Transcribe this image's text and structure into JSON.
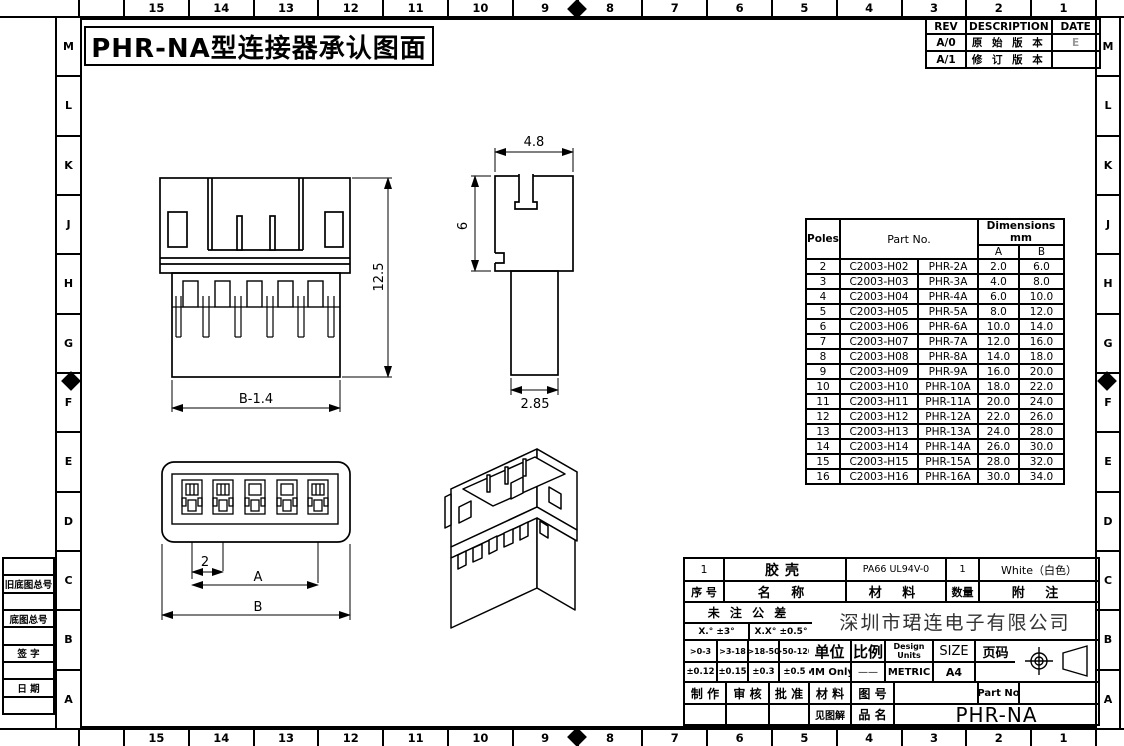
{
  "sheet": {
    "title": "PHR-NA型连接器承认图面",
    "ruler_numbers": [
      "15",
      "14",
      "13",
      "12",
      "11",
      "10",
      "9",
      "8",
      "7",
      "6",
      "5",
      "4",
      "3",
      "2",
      "1"
    ],
    "letters": [
      "M",
      "L",
      "K",
      "J",
      "H",
      "G",
      "F",
      "E",
      "D",
      "C",
      "B",
      "A"
    ],
    "margin_boxes": [
      "",
      "旧底图总号",
      "",
      "底图总号",
      "",
      "签 字",
      "",
      "日 期",
      ""
    ]
  },
  "rev_table": {
    "headers": [
      "REV",
      "DESCRIPTION",
      "DATE"
    ],
    "rows": [
      {
        "rev": "A/0",
        "desc": "原 始 版 本",
        "date": "E"
      },
      {
        "rev": "A/1",
        "desc": "修 订 版 本",
        "date": ""
      }
    ]
  },
  "parts_table": {
    "header": {
      "poles": "Poles",
      "part_no": "Part No.",
      "dims": "Dimensions mm",
      "a": "A",
      "b": "B"
    },
    "rows": [
      {
        "poles": "2",
        "part1": "C2003-H02",
        "part2": "PHR-2A",
        "a": "2.0",
        "b": "6.0"
      },
      {
        "poles": "3",
        "part1": "C2003-H03",
        "part2": "PHR-3A",
        "a": "4.0",
        "b": "8.0"
      },
      {
        "poles": "4",
        "part1": "C2003-H04",
        "part2": "PHR-4A",
        "a": "6.0",
        "b": "10.0"
      },
      {
        "poles": "5",
        "part1": "C2003-H05",
        "part2": "PHR-5A",
        "a": "8.0",
        "b": "12.0"
      },
      {
        "poles": "6",
        "part1": "C2003-H06",
        "part2": "PHR-6A",
        "a": "10.0",
        "b": "14.0"
      },
      {
        "poles": "7",
        "part1": "C2003-H07",
        "part2": "PHR-7A",
        "a": "12.0",
        "b": "16.0"
      },
      {
        "poles": "8",
        "part1": "C2003-H08",
        "part2": "PHR-8A",
        "a": "14.0",
        "b": "18.0"
      },
      {
        "poles": "9",
        "part1": "C2003-H09",
        "part2": "PHR-9A",
        "a": "16.0",
        "b": "20.0"
      },
      {
        "poles": "10",
        "part1": "C2003-H10",
        "part2": "PHR-10A",
        "a": "18.0",
        "b": "22.0"
      },
      {
        "poles": "11",
        "part1": "C2003-H11",
        "part2": "PHR-11A",
        "a": "20.0",
        "b": "24.0"
      },
      {
        "poles": "12",
        "part1": "C2003-H12",
        "part2": "PHR-12A",
        "a": "22.0",
        "b": "26.0"
      },
      {
        "poles": "13",
        "part1": "C2003-H13",
        "part2": "PHR-13A",
        "a": "24.0",
        "b": "28.0"
      },
      {
        "poles": "14",
        "part1": "C2003-H14",
        "part2": "PHR-14A",
        "a": "26.0",
        "b": "30.0"
      },
      {
        "poles": "15",
        "part1": "C2003-H15",
        "part2": "PHR-15A",
        "a": "28.0",
        "b": "32.0"
      },
      {
        "poles": "16",
        "part1": "C2003-H16",
        "part2": "PHR-16A",
        "a": "30.0",
        "b": "34.0"
      }
    ]
  },
  "dims": {
    "front_width": "B-1.4",
    "front_height": "12.5",
    "side_width": "4.8",
    "side_height": "6",
    "side_stem": "2.85",
    "pitch": "2",
    "dim_a": "A",
    "dim_b": "B"
  },
  "title_block": {
    "bom": {
      "no": "1",
      "name": "胶壳",
      "material": "PA66 UL94V-0",
      "qty": "1",
      "note": "White（白色）"
    },
    "bom_header": {
      "no": "序 号",
      "name": "名  称",
      "material": "材  料",
      "qty": "数量",
      "note": "附  注"
    },
    "untoleranced": "未 注 公 差",
    "angle_tol_1": "X.° ±3°",
    "angle_tol_2": "X.X° ±0.5°",
    "company": "深圳市珺连电子有限公司",
    "ranges": [
      ">0-3",
      ">3-18",
      ">18-50",
      ">50-120"
    ],
    "tolerances": [
      "±0.12",
      "±0.15",
      "±0.3",
      "±0.5"
    ],
    "unit_label": "单位",
    "unit_value": "MM Only",
    "scale_label": "比例",
    "scale_value": "——",
    "design_units_label_1": "Design",
    "design_units_label_2": "Units",
    "design_units_value": "METRIC",
    "size_label": "SIZE",
    "size_value": "A4",
    "page_label": "页码",
    "page_value": "",
    "make_label": "制 作",
    "check_label": "审 核",
    "approve_label": "批 准",
    "material_label": "材 料",
    "drawing_no_label": "图 号",
    "part_no_label": "Part No",
    "see_note": "见图解",
    "product_name_label": "品 名",
    "product_name": "PHR-NA"
  }
}
